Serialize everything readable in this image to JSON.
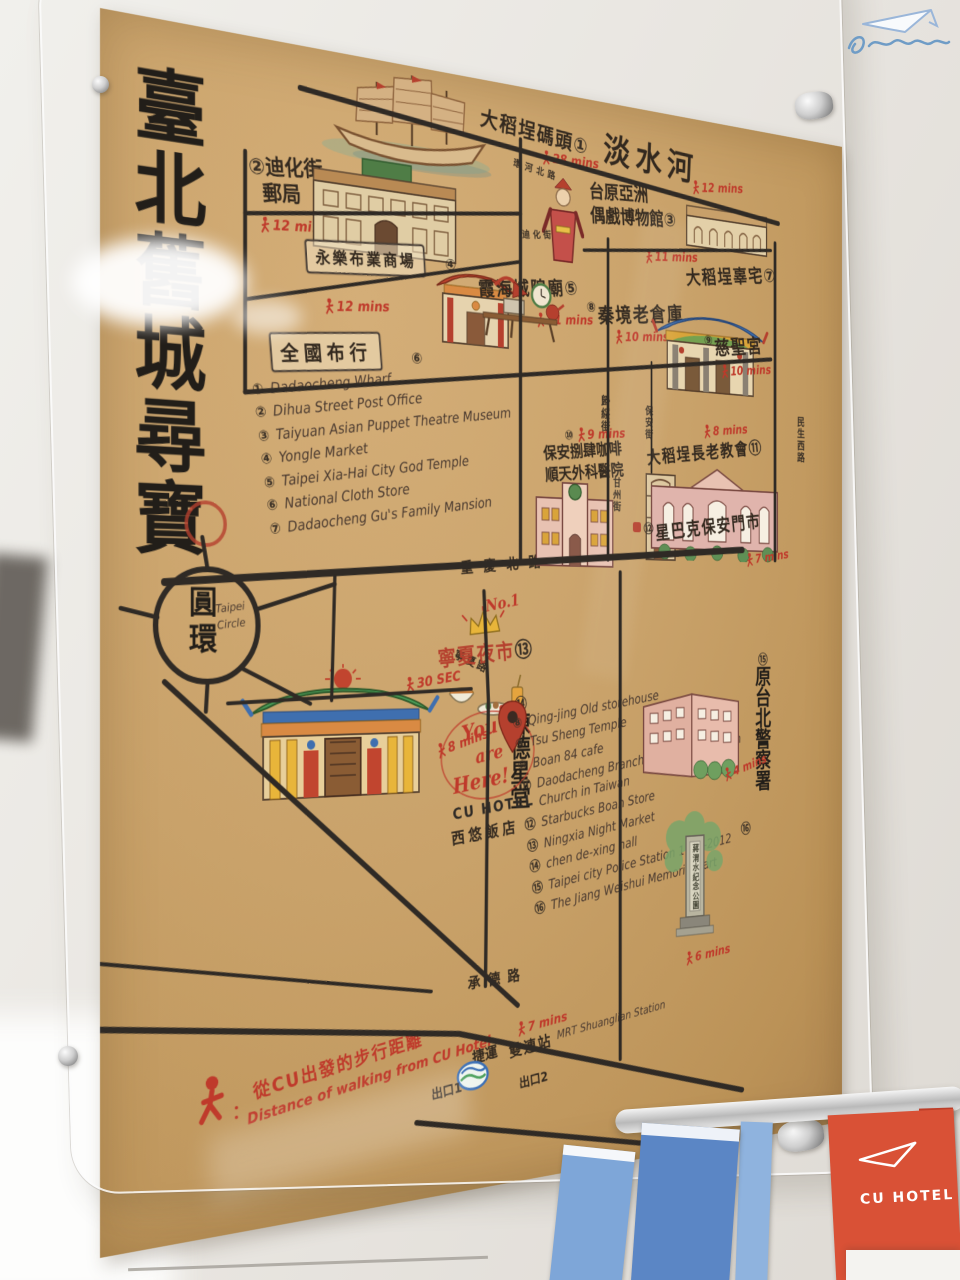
{
  "poster": {
    "title": "臺北舊城尋寶",
    "river": "淡水河",
    "roads": {
      "huanhe": "環河北路",
      "dihua": "迪化街",
      "guisui": "歸綏街",
      "minsheng": "民生西路",
      "baoan": "保安街",
      "ganzhou": "甘州街",
      "chongqing": "重慶北路",
      "ningxia": "寧夏路",
      "pingyang": "平陽街",
      "jinxi": "錦西街",
      "chengde": "承德路"
    },
    "circle": {
      "zh": "圓環",
      "en1": "Taipei",
      "en2": "Circle"
    },
    "pois": {
      "wharf": {
        "zh": "大稻埕碼頭",
        "num": "①",
        "time": "28 mins"
      },
      "post_office": {
        "zh_line1": "迪化街",
        "zh_line2": "郵局",
        "num": "②",
        "time": "12 mins"
      },
      "puppet_museum": {
        "zh_line1": "台原亞洲",
        "zh_line2": "偶戲博物館",
        "num": "③",
        "time": "11 mins"
      },
      "yongle_market": {
        "zh": "永樂布業商場",
        "num": "④",
        "time": "12 mins"
      },
      "city_god_temple": {
        "zh": "霞海城隍廟",
        "num": "⑤",
        "time": "11 mins"
      },
      "cloth_store": {
        "zh": "全國布行",
        "num": "⑥"
      },
      "gu_mansion": {
        "zh": "大稻埕辜宅",
        "num": "⑦",
        "time": "12 mins"
      },
      "storehouse": {
        "zh": "秦境老倉庫",
        "num": "⑧",
        "time": "10 mins"
      },
      "cisheng_temple": {
        "zh": "慈聖宮",
        "num": "⑨",
        "time": "10 mins"
      },
      "boan84": {
        "zh_line1": "保安捌肆咖啡",
        "zh_line2": "順天外科醫院",
        "num": "⑩",
        "time": "9 mins"
      },
      "church": {
        "zh": "大稻埕長老教會",
        "num": "⑪",
        "time": "8 mins"
      },
      "starbucks": {
        "zh": "星巴克保安門市",
        "num": "⑫",
        "time": "7 mins"
      },
      "night_market": {
        "zh": "寧夏夜市",
        "num": "⑬",
        "time": "30 SEC",
        "badge": "No.1"
      },
      "chen_dexing": {
        "zh": "陳德星堂",
        "num": "⑭",
        "time": "8 mins"
      },
      "police": {
        "zh": "原台北警察署",
        "num": "⑮",
        "time": "4 mins"
      },
      "memorial": {
        "zh": "蔣渭水紀念公園",
        "num": "⑯",
        "time": "6 mins"
      }
    },
    "legend1": {
      "items": [
        {
          "num": "①",
          "text": "Dadaocheng Wharf"
        },
        {
          "num": "②",
          "text": "Dihua Street Post Office"
        },
        {
          "num": "③",
          "text": "Taiyuan Asian Puppet Theatre Museum"
        },
        {
          "num": "④",
          "text": "Yongle Market"
        },
        {
          "num": "⑤",
          "text": "Taipei Xia-Hai City God Temple"
        },
        {
          "num": "⑥",
          "text": "National Cloth Store"
        },
        {
          "num": "⑦",
          "text": "Dadaocheng Gu's Family Mansion"
        }
      ]
    },
    "legend2": {
      "items": [
        {
          "num": "⑧",
          "text": "Qing-jing Old storehouse"
        },
        {
          "num": "⑨",
          "text": "Tsu Sheng Temple"
        },
        {
          "num": "⑩",
          "text": "Boan 84 cafe"
        },
        {
          "num": "⑪",
          "text": "Daodacheng Branch of the Presbyterian Church in Taiwan"
        },
        {
          "num": "⑫",
          "text": "Starbucks Boan Store"
        },
        {
          "num": "⑬",
          "text": "Ningxia Night Market"
        },
        {
          "num": "⑭",
          "text": "chen de-xing hall"
        },
        {
          "num": "⑮",
          "text": "Taipei city Police Station 1933-2012"
        },
        {
          "num": "⑯",
          "text": "The Jiang Weishui Memorial Part"
        }
      ]
    },
    "you_are_here": {
      "l1": "You",
      "l2": "are",
      "l3": "Here!",
      "hotel": "CU HOTEL",
      "hotel_zh": "西悠飯店"
    },
    "footer": {
      "colon": "：",
      "zh": "從CU出發的步行距離",
      "en": "Distance of walking from CU Hotel"
    },
    "mrt": {
      "time": "7 mins",
      "zh_jieyun": "捷運",
      "zh_station": "雙連站",
      "en": "MRT Shuanglian Station",
      "exit1": "出口1",
      "exit2": "出口2"
    }
  },
  "shelf": {
    "brochure_label": "CU HOTEL"
  },
  "colors": {
    "ink": "#2f2a25",
    "red": "#bf3a2b",
    "paper": "#c9a26a"
  }
}
